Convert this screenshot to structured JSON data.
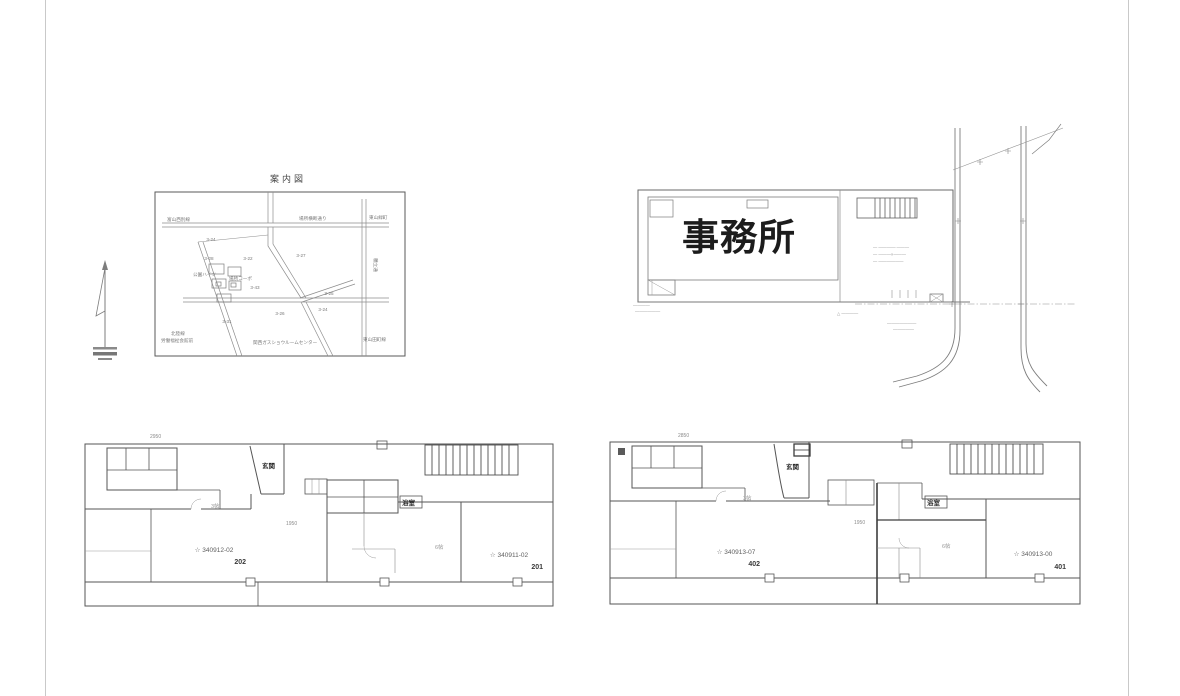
{
  "map": {
    "title": "案内図",
    "labels": [
      {
        "id": "road-top-left",
        "text": "富山西別線"
      },
      {
        "id": "road-top-center",
        "text": "場所横断通り"
      },
      {
        "id": "road-top-right",
        "text": "東山緑町"
      },
      {
        "id": "road-right",
        "text": "穂立通"
      },
      {
        "id": "plot-1",
        "text": "3-24"
      },
      {
        "id": "plot-2",
        "text": "3-28"
      },
      {
        "id": "plot-3",
        "text": "3-22"
      },
      {
        "id": "plot-4",
        "text": "3-27"
      },
      {
        "id": "bldg-1",
        "text": "公園ハイツ"
      },
      {
        "id": "bldg-2",
        "text": "場所コーポ"
      },
      {
        "id": "plot-5",
        "text": "3-43"
      },
      {
        "id": "plot-6",
        "text": "3-25"
      },
      {
        "id": "plot-7",
        "text": "3-24"
      },
      {
        "id": "plot-8",
        "text": "3-26"
      },
      {
        "id": "plot-9",
        "text": "3-31"
      },
      {
        "id": "note-bl-1",
        "text": "北陸線"
      },
      {
        "id": "note-bl-2",
        "text": "労働福祉会館前"
      },
      {
        "id": "note-bc",
        "text": "関西ガスショウルームセンター"
      },
      {
        "id": "road-bottom-right",
        "text": "東山田町線"
      }
    ]
  },
  "site_plan": {
    "building_label": "事務所",
    "leader_notes": [
      "— ————·———",
      "— ———×———",
      "— ——————"
    ],
    "mid_note": "△ ————",
    "bottom_notes": [
      "———————",
      "—————"
    ],
    "left_notes": [
      "————",
      "——————"
    ]
  },
  "floor_plans": {
    "left": {
      "dim_top": "2950",
      "dim_mid": "1950",
      "entrance_label": "玄関",
      "bath_label": "浴室",
      "room_a": "3帖",
      "room_b": "6帖",
      "unit_left": {
        "code": "☆ 340912-02",
        "number": "202"
      },
      "unit_right": {
        "code": "☆ 340911-02",
        "number": "201"
      }
    },
    "right": {
      "dim_top": "2850",
      "dim_mid": "1950",
      "entrance_label": "玄関",
      "bath_label": "浴室",
      "room_a": "3帖",
      "room_b": "6帖",
      "unit_left": {
        "code": "☆ 340913-07",
        "number": "402"
      },
      "unit_right": {
        "code": "☆ 340913-00",
        "number": "401"
      }
    }
  }
}
